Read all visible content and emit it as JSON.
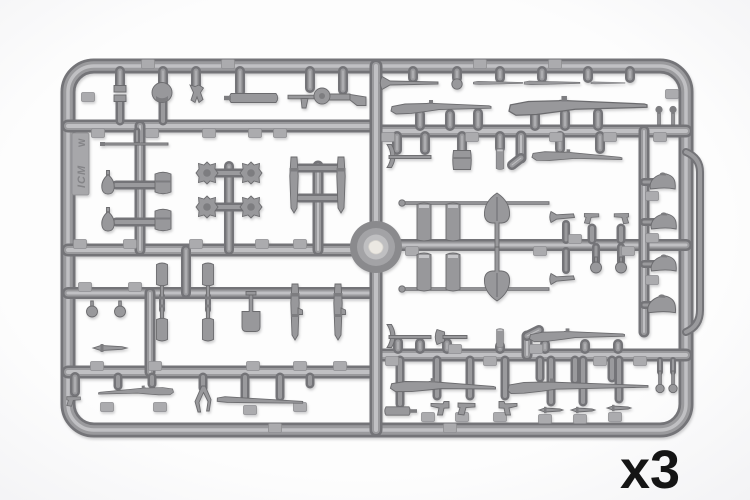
{
  "labels": {
    "quantity": "x3"
  },
  "logo": {
    "brand": "ICM",
    "mark": "W"
  },
  "palette": {
    "bg_center": "#fdfdfd",
    "bg_edge": "#e9e9ec",
    "runner_dark": "#747478",
    "runner_mid": "#9a9a9d",
    "runner_light": "#c0c0c3",
    "part_fill": "#98989b",
    "part_stroke": "#6b6b6e",
    "part_dark": "#7d7d80",
    "part_light": "#c6c6c9",
    "tag_fill": "#ababae",
    "tag_stroke": "#8f8f92",
    "hub_outer": "#8a8a8d",
    "hub_mid": "#a3a3a6",
    "hub_inner": "#bfbfc1",
    "hub_gate": "#ebe8e2",
    "label_color": "#151515"
  },
  "sprue": {
    "frame": {
      "x": 68,
      "y": 66,
      "w": 618,
      "h": 364,
      "r": 26,
      "bar": 12
    },
    "handle_path": "M 686 152 Q 700 158 700 172 L 700 310 Q 700 326 686 332",
    "hub": {
      "cx": 376,
      "cy": 247,
      "r_outer": 26,
      "r_mid": 19,
      "r_inner": 12.5
    },
    "runners": [
      [
        68,
        126,
        376,
        126,
        11
      ],
      [
        376,
        131,
        686,
        131,
        11
      ],
      [
        68,
        250,
        376,
        250,
        11
      ],
      [
        376,
        245,
        686,
        245,
        10
      ],
      [
        68,
        293,
        376,
        293,
        10
      ],
      [
        68,
        372,
        376,
        372,
        11
      ],
      [
        376,
        355,
        686,
        355,
        11
      ],
      [
        376,
        66,
        376,
        430,
        11
      ],
      [
        150,
        293,
        150,
        372,
        9
      ],
      [
        140,
        126,
        140,
        250,
        9
      ],
      [
        116,
        185,
        160,
        185,
        7
      ],
      [
        116,
        222,
        160,
        222,
        7
      ],
      [
        229,
        166,
        229,
        250,
        8
      ],
      [
        216,
        173,
        242,
        173,
        7
      ],
      [
        216,
        207,
        242,
        207,
        7
      ],
      [
        318,
        166,
        318,
        250,
        9
      ],
      [
        299,
        168,
        337,
        168,
        7
      ],
      [
        299,
        198,
        337,
        198,
        7
      ],
      [
        186,
        250,
        186,
        293,
        8
      ],
      [
        162,
        296,
        162,
        310,
        4
      ],
      [
        208,
        296,
        208,
        310,
        4
      ],
      [
        120,
        71,
        120,
        86,
        8
      ],
      [
        163,
        71,
        163,
        84,
        8
      ],
      [
        196,
        71,
        196,
        86,
        8
      ],
      [
        240,
        71,
        240,
        92,
        8
      ],
      [
        310,
        71,
        310,
        88,
        8
      ],
      [
        343,
        71,
        343,
        90,
        8
      ],
      [
        120,
        102,
        120,
        121,
        7
      ],
      [
        163,
        101,
        163,
        121,
        7
      ],
      [
        137,
        131,
        137,
        141,
        5
      ],
      [
        413,
        71,
        413,
        78,
        8
      ],
      [
        457,
        71,
        457,
        78,
        8
      ],
      [
        500,
        71,
        500,
        78,
        8
      ],
      [
        542,
        71,
        542,
        78,
        8
      ],
      [
        588,
        71,
        588,
        78,
        8
      ],
      [
        630,
        71,
        630,
        78,
        8
      ],
      [
        420,
        114,
        420,
        126,
        8
      ],
      [
        450,
        114,
        450,
        126,
        8
      ],
      [
        478,
        113,
        478,
        126,
        8
      ],
      [
        535,
        113,
        535,
        126,
        8
      ],
      [
        565,
        113,
        565,
        126,
        8
      ],
      [
        598,
        113,
        598,
        126,
        8
      ],
      [
        397,
        136,
        397,
        150,
        8
      ],
      [
        425,
        136,
        425,
        150,
        8
      ],
      [
        462,
        136,
        462,
        150,
        8
      ],
      [
        500,
        136,
        500,
        148,
        8
      ],
      [
        560,
        136,
        560,
        149,
        8
      ],
      [
        600,
        136,
        600,
        149,
        8
      ],
      [
        521,
        136,
        521,
        158,
        9
      ],
      [
        521,
        158,
        512,
        165,
        8
      ],
      [
        644,
        131,
        644,
        332,
        9
      ],
      [
        644,
        182,
        656,
        182,
        6
      ],
      [
        644,
        222,
        656,
        222,
        6
      ],
      [
        644,
        264,
        656,
        264,
        6
      ],
      [
        644,
        305,
        654,
        305,
        6
      ],
      [
        592,
        228,
        592,
        240,
        7
      ],
      [
        621,
        228,
        621,
        240,
        7
      ],
      [
        596,
        247,
        596,
        262,
        6
      ],
      [
        621,
        247,
        621,
        262,
        6
      ],
      [
        566,
        224,
        566,
        240,
        6
      ],
      [
        566,
        251,
        566,
        270,
        6
      ],
      [
        398,
        342,
        398,
        349,
        8
      ],
      [
        420,
        343,
        420,
        349,
        8
      ],
      [
        447,
        343,
        447,
        349,
        8
      ],
      [
        500,
        346,
        500,
        349,
        8
      ],
      [
        545,
        344,
        545,
        349,
        8
      ],
      [
        585,
        344,
        585,
        349,
        8
      ],
      [
        618,
        344,
        618,
        349,
        8
      ],
      [
        527,
        336,
        527,
        355,
        9
      ],
      [
        527,
        336,
        539,
        330,
        8
      ],
      [
        400,
        360,
        400,
        404,
        7
      ],
      [
        437,
        360,
        437,
        396,
        7
      ],
      [
        470,
        360,
        470,
        396,
        7
      ],
      [
        505,
        360,
        505,
        396,
        7
      ],
      [
        540,
        360,
        540,
        378,
        7
      ],
      [
        575,
        360,
        575,
        380,
        7
      ],
      [
        612,
        360,
        612,
        378,
        7
      ],
      [
        551,
        360,
        551,
        402,
        7
      ],
      [
        583,
        360,
        583,
        402,
        7
      ],
      [
        619,
        360,
        619,
        399,
        7
      ],
      [
        660,
        360,
        660,
        372,
        4
      ],
      [
        673,
        360,
        673,
        372,
        4
      ],
      [
        75,
        377,
        75,
        392,
        8
      ],
      [
        118,
        377,
        118,
        386,
        7
      ],
      [
        152,
        377,
        152,
        384,
        7
      ],
      [
        203,
        377,
        203,
        388,
        7
      ],
      [
        245,
        377,
        245,
        397,
        7
      ],
      [
        280,
        377,
        280,
        397,
        7
      ],
      [
        310,
        377,
        310,
        384,
        7
      ]
    ],
    "tags": [
      [
        98,
        133
      ],
      [
        152,
        133
      ],
      [
        209,
        133
      ],
      [
        255,
        133
      ],
      [
        280,
        133
      ],
      [
        388,
        137
      ],
      [
        472,
        137
      ],
      [
        556,
        137
      ],
      [
        610,
        137
      ],
      [
        660,
        137
      ],
      [
        80,
        244
      ],
      [
        130,
        244
      ],
      [
        196,
        244
      ],
      [
        262,
        244
      ],
      [
        300,
        244
      ],
      [
        412,
        251
      ],
      [
        540,
        251
      ],
      [
        575,
        239
      ],
      [
        628,
        251
      ],
      [
        85,
        287
      ],
      [
        135,
        287
      ],
      [
        97,
        366
      ],
      [
        155,
        366
      ],
      [
        253,
        366
      ],
      [
        300,
        366
      ],
      [
        340,
        366
      ],
      [
        392,
        361
      ],
      [
        455,
        349
      ],
      [
        490,
        361
      ],
      [
        536,
        349
      ],
      [
        600,
        361
      ],
      [
        640,
        361
      ],
      [
        275,
        428
      ],
      [
        450,
        428
      ],
      [
        672,
        94
      ],
      [
        652,
        196
      ],
      [
        652,
        238
      ],
      [
        652,
        280
      ],
      [
        148,
        64
      ],
      [
        228,
        64
      ],
      [
        480,
        64
      ],
      [
        555,
        64
      ],
      [
        88,
        97
      ],
      [
        428,
        417
      ],
      [
        462,
        417
      ],
      [
        500,
        417
      ],
      [
        545,
        419
      ],
      [
        580,
        419
      ],
      [
        615,
        417
      ],
      [
        107,
        407
      ],
      [
        160,
        407
      ],
      [
        250,
        410
      ],
      [
        300,
        407
      ]
    ],
    "parts": [
      [
        "clip",
        120,
        94
      ],
      [
        "pouch_round",
        162,
        93
      ],
      [
        "small_equipment",
        197,
        94
      ],
      [
        "cylinder_h",
        255,
        98
      ],
      [
        "mg",
        328,
        97
      ],
      [
        "thin_rod",
        136,
        144
      ],
      [
        "grenade_egg",
        108,
        184
      ],
      [
        "grenade_egg",
        108,
        221
      ],
      [
        "pouch_cyl",
        163,
        184
      ],
      [
        "pouch_cyl",
        163,
        221
      ],
      [
        "cog",
        207,
        173
      ],
      [
        "cog",
        251,
        173
      ],
      [
        "cog",
        207,
        207
      ],
      [
        "cog",
        251,
        207
      ],
      [
        "blade_down",
        294,
        185
      ],
      [
        "blade_down",
        341,
        185
      ],
      [
        "ball",
        92,
        312
      ],
      [
        "ball",
        120,
        312
      ],
      [
        "bayonet",
        110,
        348
      ],
      [
        "canteen",
        162,
        274,
        180
      ],
      [
        "canteen",
        208,
        274,
        180
      ],
      [
        "canteen",
        162,
        330
      ],
      [
        "canteen",
        208,
        330
      ],
      [
        "spade_sq",
        251,
        312
      ],
      [
        "carbine_v",
        295,
        312
      ],
      [
        "carbine_v",
        338,
        312
      ],
      [
        "pistol",
        74,
        399,
        0,
        0.8
      ],
      [
        "rifle",
        136,
        392,
        -3,
        0.75,
        -1
      ],
      [
        "wishbone",
        203,
        399
      ],
      [
        "rifle_thin",
        260,
        401,
        2,
        0.95
      ],
      [
        "mop",
        410,
        83
      ],
      [
        "knob",
        457,
        84
      ],
      [
        "rifle_thin",
        498,
        83,
        0,
        0.55
      ],
      [
        "rifle_thin",
        552,
        83,
        0,
        0.62
      ],
      [
        "rifle_thin",
        608,
        83,
        0,
        0.38
      ],
      [
        "rifle",
        441,
        108
      ],
      [
        "rifle",
        578,
        107,
        0,
        1.38
      ],
      [
        "flare",
        659,
        115
      ],
      [
        "flare",
        673,
        115
      ],
      [
        "pickaxe",
        408,
        157
      ],
      [
        "box",
        462,
        160
      ],
      [
        "cylinder_v",
        500,
        159,
        0,
        0.55
      ],
      [
        "rifle",
        577,
        157,
        3,
        0.9
      ],
      [
        "rod",
        477,
        203
      ],
      [
        "rod",
        477,
        289
      ],
      [
        "cylinder_v",
        424,
        222
      ],
      [
        "cylinder_v",
        453,
        222
      ],
      [
        "cylinder_v",
        424,
        272
      ],
      [
        "cylinder_v",
        453,
        272
      ],
      [
        "shovel_up",
        497,
        225
      ],
      [
        "shovel_up",
        497,
        269,
        180
      ],
      [
        "horn",
        563,
        217
      ],
      [
        "horn",
        563,
        279
      ],
      [
        "pistol",
        592,
        216,
        0,
        0.85
      ],
      [
        "pistol",
        621,
        216,
        0,
        0.85,
        -1
      ],
      [
        "ball",
        596,
        268
      ],
      [
        "ball",
        621,
        268
      ],
      [
        "helmet",
        663,
        182
      ],
      [
        "helmet",
        664,
        222
      ],
      [
        "helmet",
        664,
        264
      ],
      [
        "helmet",
        662,
        305,
        0,
        1.1
      ],
      [
        "pickaxe",
        408,
        337
      ],
      [
        "hatchet",
        452,
        337
      ],
      [
        "cylinder_v",
        500,
        338,
        0,
        0.5
      ],
      [
        "rifle",
        577,
        336,
        0,
        0.95
      ],
      [
        "suppressor",
        400,
        411
      ],
      [
        "rifle",
        443,
        387,
        2,
        1.05
      ],
      [
        "mauser",
        442,
        406
      ],
      [
        "pistol",
        467,
        406
      ],
      [
        "mauser",
        506,
        406,
        0,
        1,
        -1
      ],
      [
        "rifle_long",
        578,
        387
      ],
      [
        "knife",
        551,
        410
      ],
      [
        "knife",
        583,
        410
      ],
      [
        "knife",
        619,
        408
      ],
      [
        "tpart",
        660,
        381
      ],
      [
        "tpart",
        673,
        381
      ]
    ],
    "legend": {
      "rifle": "bolt-action rifle",
      "rifle_long": "rifle with fixed bayonet",
      "rifle_thin": "slim rifle",
      "mop": "rifle with muzzle cover",
      "mg": "light machine gun",
      "pistol": "pistol",
      "mauser": "Mauser pistol",
      "knife": "trench knife",
      "bayonet": "bayonet",
      "blade_down": "bayonet in scabbard",
      "carbine_v": "folded tool",
      "shovel_up": "round-point shovel",
      "spade_sq": "square spade",
      "pickaxe": "pickaxe",
      "hatchet": "hatchet",
      "helmet": "Adrian helmet",
      "grenade_egg": "egg grenade",
      "ball": "ball grenade",
      "canteen": "flask",
      "pouch_cyl": "grenade head",
      "pouch_round": "round pouch",
      "cylinder_v": "canister",
      "cylinder_h": "case",
      "box": "ammo pouch",
      "rod": "cleaning rod",
      "thin_rod": "ramrod",
      "cog": "cogwheel",
      "horn": "bugle",
      "wishbone": "slingshot frame",
      "flare": "flare cartridge",
      "clip": "ammo clips",
      "small_equipment": "holster",
      "tpart": "lid part",
      "suppressor": "launcher cup",
      "knob": "fuse cap"
    }
  }
}
